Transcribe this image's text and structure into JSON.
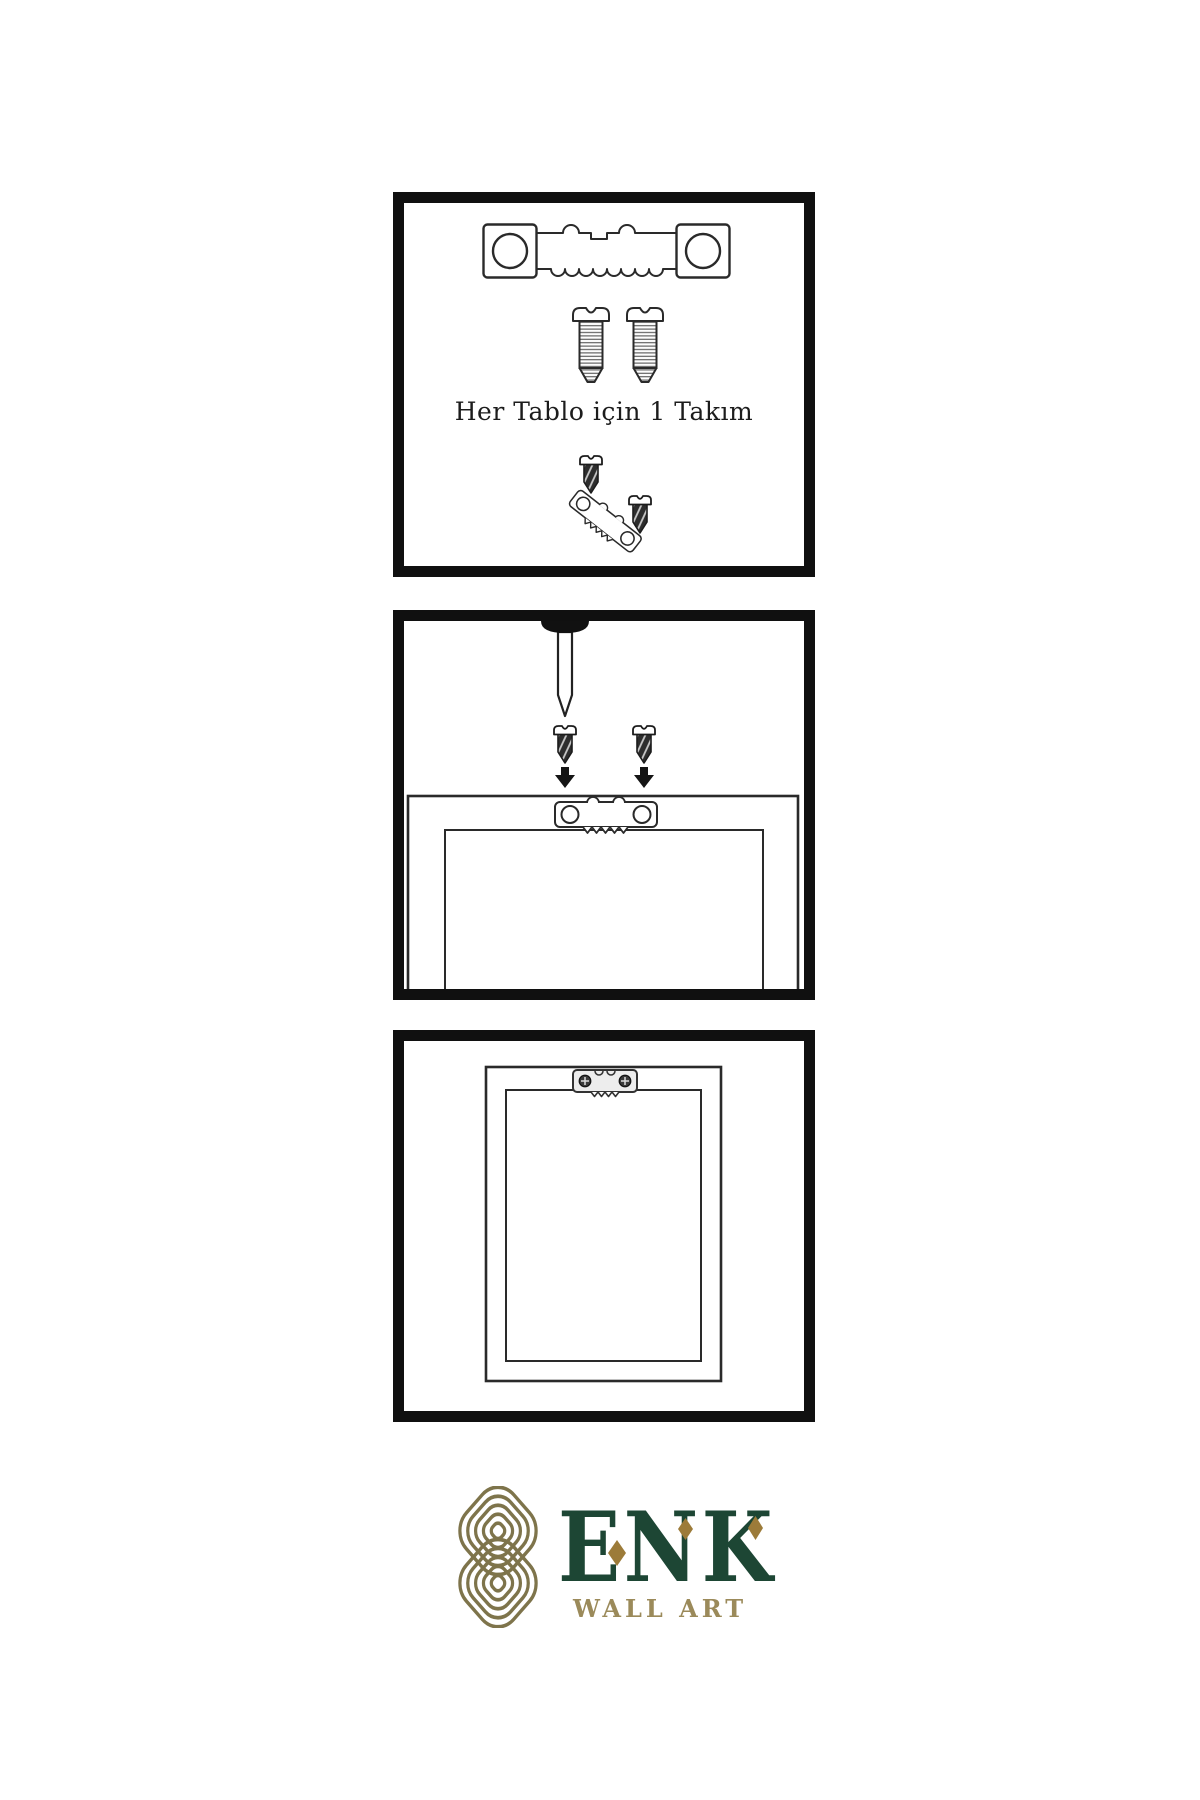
{
  "meta": {
    "type": "wall-art-hanging-instruction-sheet"
  },
  "colors": {
    "background": "#ffffff",
    "line": "#2a2a2a",
    "panel_border": "#101010",
    "brand_green": "#1d4634",
    "brand_gold": "#9b8a5a",
    "knot_gold": "#7e744b",
    "diamond_gold": "#9c7b39"
  },
  "panels": [
    {
      "name": "hardware-kit",
      "caption": "Her Tablo için 1 Takım",
      "items": [
        "sawtooth-hanger-icon",
        "screw-icon",
        "screw-icon",
        "screw-into-hanger-icon"
      ]
    },
    {
      "name": "mount-hanger-step",
      "items": [
        "wall-nail-icon",
        "screw-icon",
        "screw-icon",
        "arrow-down-icon",
        "arrow-down-icon",
        "frame-back-icon",
        "sawtooth-hanger-icon"
      ]
    },
    {
      "name": "hang-frame-step",
      "items": [
        "frame-back-icon",
        "mounted-sawtooth-hanger-icon"
      ]
    }
  ],
  "logo": {
    "brand": "ENK",
    "subtitle": "WALL ART",
    "icon": "knot-logo-icon"
  }
}
